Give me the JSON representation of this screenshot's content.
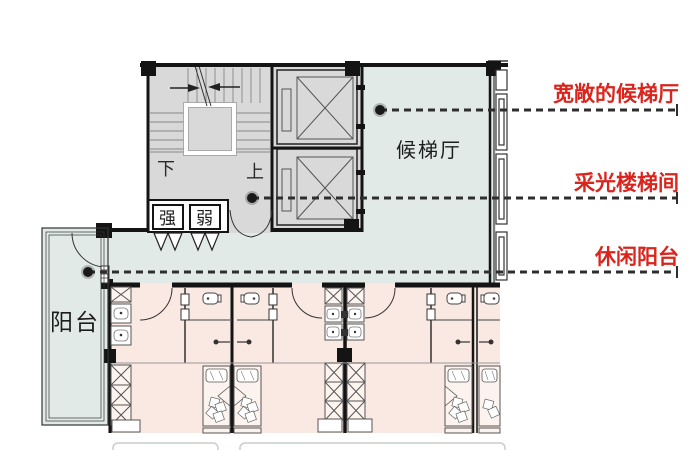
{
  "floor_plan": {
    "rooms": {
      "lobby_label": "候梯厅",
      "balcony_label": "阳台",
      "strong_electric_label": "强",
      "weak_electric_label": "弱",
      "stair_down_label": "下",
      "stair_up_label": "上"
    },
    "annotations": [
      {
        "id": "lobby",
        "label": "宽敞的候梯厅"
      },
      {
        "id": "stairwell",
        "label": "采光楼梯间"
      },
      {
        "id": "balcony",
        "label": "休闲阳台"
      }
    ],
    "colors": {
      "lobby_fill": "#e2eae7",
      "balcony_fill": "#e2eae7",
      "room_fill": "#f9e9e2",
      "stair_fill": "#d9d9d9",
      "wall": "#141414",
      "annotation_red": "#d9251d",
      "leader_line": "#2e2e2e"
    }
  }
}
